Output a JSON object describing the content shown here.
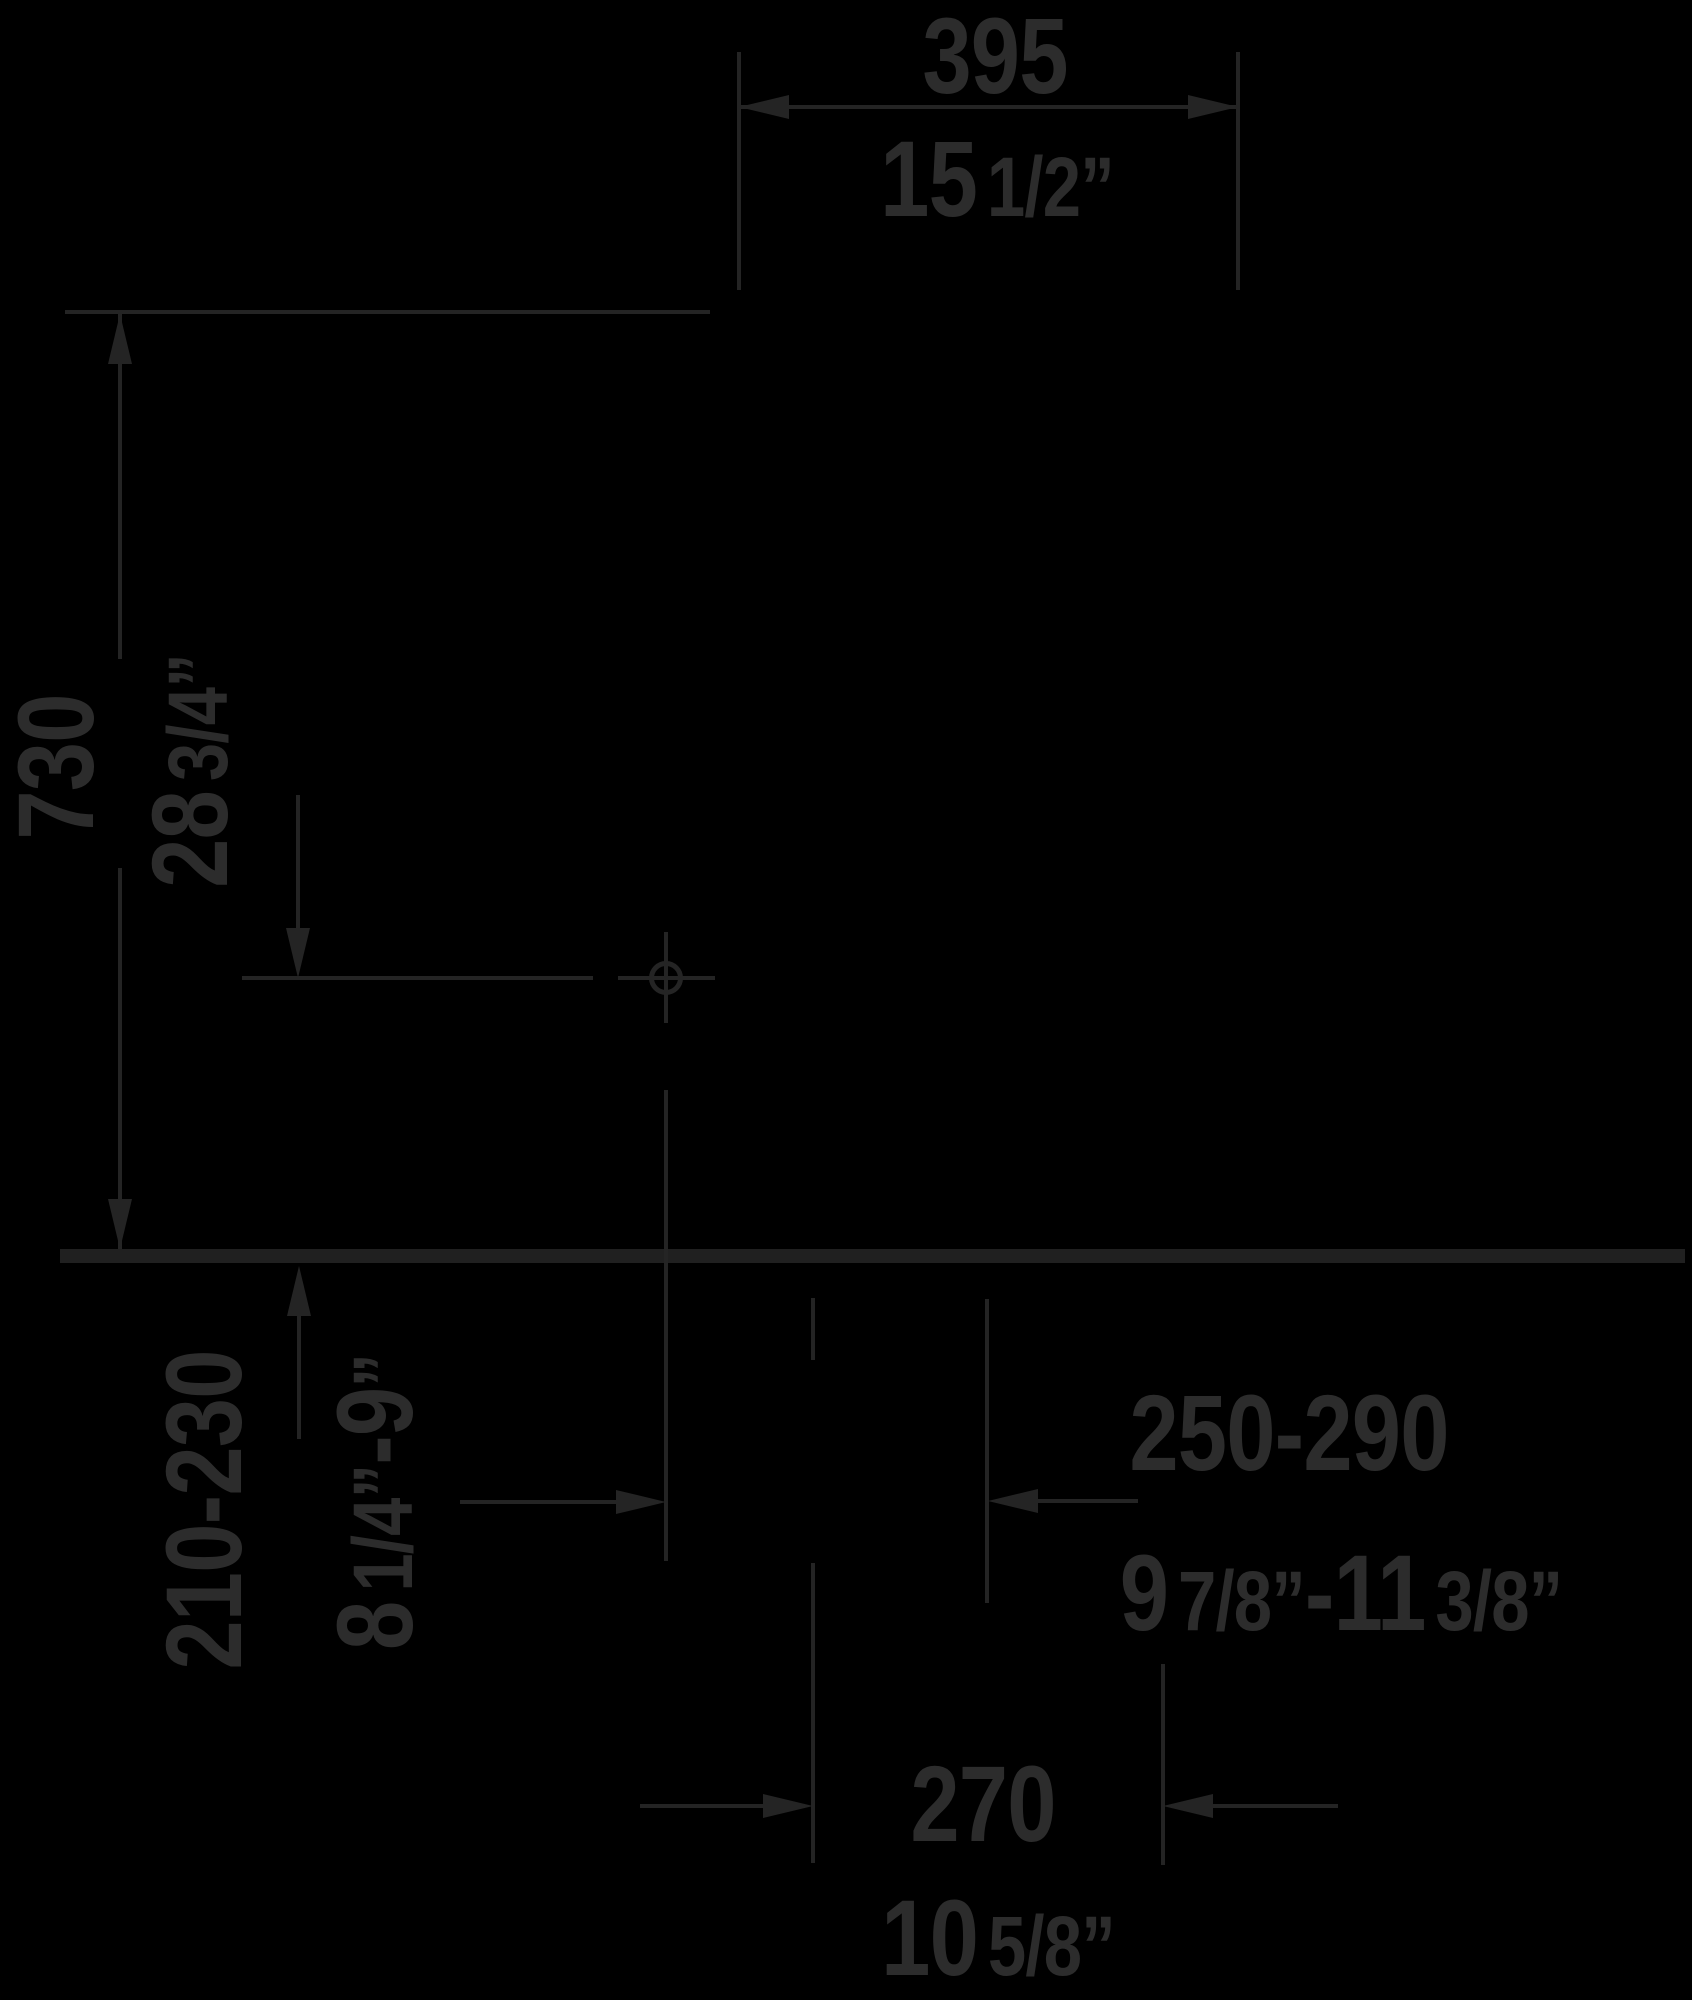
{
  "drawing": {
    "type": "technical-dimension-diagram",
    "units": [
      "mm",
      "inch"
    ],
    "colors": {
      "background": "#000000",
      "line": "#242424",
      "floor_line": "#202020",
      "text": "#2c2c2c"
    },
    "icons": {
      "position_crosshair": "circle-with-crosshair"
    },
    "dimensions": [
      {
        "location": "top-width",
        "mm": "395",
        "inch": "15 1/2”"
      },
      {
        "location": "left-height",
        "mm": "730",
        "inch": "28 3/4”"
      },
      {
        "location": "bottom-left-height",
        "mm": "210-230",
        "inch": "8 1/4”-9”"
      },
      {
        "location": "bottom-right-offset",
        "mm": "250-290",
        "inch": "9 7/8”-11 3/8”"
      },
      {
        "location": "bottom-center-width",
        "mm": "270",
        "inch": "10 5/8”"
      }
    ]
  },
  "labels": {
    "top_width_mm": "395",
    "top_width_in_whole": "15",
    "top_width_in_frac": "1/2”",
    "height_mm": "730",
    "height_in_whole": "28",
    "height_in_frac": "3/4”",
    "rear_height_mm": "210-230",
    "rear_height_in_whole1": "8",
    "rear_height_in_frac1": "1/4”",
    "rear_height_in_whole2": "-9",
    "rear_height_in_frac2": "”",
    "offset_mm": "250-290",
    "offset_in_whole1": "9",
    "offset_in_frac1": "7/8”",
    "offset_in_whole2": "-11",
    "offset_in_frac2": "3/8”",
    "bottom_width_mm": "270",
    "bottom_width_in_whole": "10",
    "bottom_width_in_frac": "5/8”"
  }
}
